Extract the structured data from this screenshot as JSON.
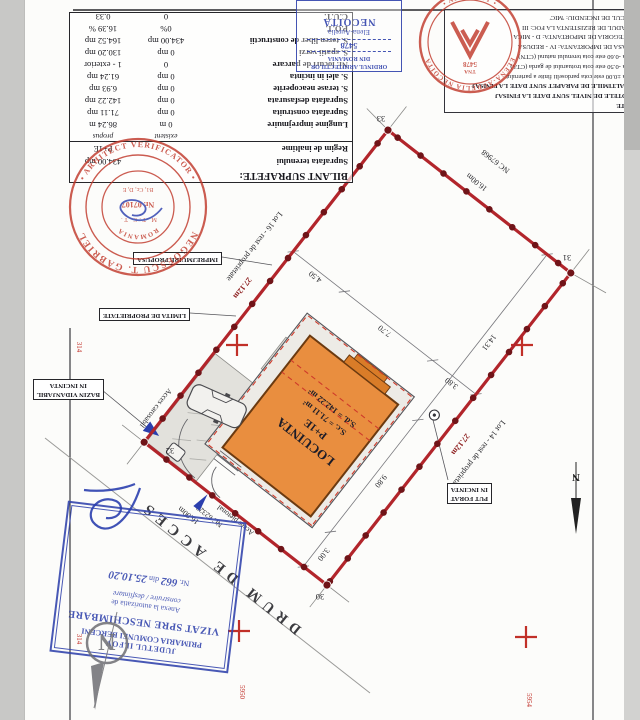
{
  "colors": {
    "boundary_red": "#b2252b",
    "building_orange": "#e98e3f",
    "stamp_red": "#c0392b",
    "stamp_blue": "#3546ad"
  },
  "surface_table": {
    "title": "BILANT SUPRAFETE:",
    "land_label": "Suprafata terenului",
    "land_value": "434.00 mp",
    "regime_label": "Regim de inaltime",
    "regime_value": "P+1E",
    "col_existent": "existent",
    "col_propus": "propus",
    "rows": [
      {
        "label": "Lungime imprejmuire",
        "existent": "0 m",
        "propus": "86.24 m"
      },
      {
        "label": "Suprafata construita",
        "existent": "0 mp",
        "propus": "71.11 mp"
      },
      {
        "label": "Suprafata desfasurata",
        "existent": "0 mp",
        "propus": "142.22 mp"
      },
      {
        "label": "S. terase neacoperite",
        "existent": "0 mp",
        "propus": "6.93 mp"
      },
      {
        "label": "S. alei in incinta",
        "existent": "0 mp",
        "propus": "61.24 mp"
      },
      {
        "label": "Nr. locuri de parcare",
        "existent": "0",
        "propus": "1 - exterior"
      },
      {
        "label": "S. spatii verzi",
        "existent": "0 mp",
        "propus": "130.20 mp"
      },
      {
        "label": "S. teren liber de constructii",
        "existent": "434.00 mp",
        "propus": "164.52 mp"
      },
      {
        "label": "P.O.T.",
        "existent": "0%",
        "propus": "16.39 %"
      },
      {
        "label": "C.U.T.",
        "existent": "0",
        "propus": "0.33"
      }
    ]
  },
  "notes": {
    "title": "NOTE",
    "lines": [
      "*COTELE DE NIVEL SUNT DATE LA FINISAJ",
      "*INALTIMILE DE PARAPET SUNT DATE LA FINISAJ",
      "Cota ±0.00 este cota pardoselii finite a parterului",
      "Cota -0.50 este cota trotuarului de garda (CTA)",
      "Cota -0.60 este cota terenului natural (CTN)",
      "CLASA DE IMPORTANTA: IV - REDUSA",
      "CATEGORIA DE IMPORTANTA: D - MICA",
      "GRADUL DE REZISTENTA LA FOC: III",
      "RISCUL DE INCENDIU: 'MIC'"
    ]
  },
  "plan": {
    "building": {
      "l1": "LOCUINTA",
      "l2": "P+1E",
      "l3": "S.c. = 71.11 m²",
      "l4": "S.d. = 142.22 m²"
    },
    "dims": {
      "front": "16.00m",
      "back": "16.00m",
      "left": "27.12m",
      "right": "27.12m",
      "w1": "3.80",
      "w2": "7.70",
      "w3": "4.50",
      "h1": "3.00",
      "h2": "9.80",
      "h3": "14.31"
    },
    "corners": {
      "c30": "30",
      "c31": "31",
      "c32": "32",
      "c33": "33"
    },
    "labels": {
      "lot14": "Lot 14 - rest de proprietate",
      "lot16": "Lot 16 - rest de proprietate",
      "nc_back": "NC 67968",
      "nc_road": "NC 62323",
      "road": "DRUM DE ACCES",
      "acces_pietonal": "Acces pietonal",
      "acces_carosabil": "Acces carosabil",
      "put_forat_1": "PUT FORAT",
      "put_forat_2": "IN INCINTA",
      "bazin_1": "BAZIN VIDANJABIL",
      "bazin_2": "IN INCINTA",
      "imprejmuire": "IMPREJMUIRE PROPUSA",
      "limita": "LIMITA DE PROPRIETATE",
      "north": "N"
    },
    "grid": {
      "g1": "314",
      "g2": "314",
      "g3": "5950",
      "g4": "5954"
    }
  },
  "stamps": {
    "vizat": {
      "l1": "JUDETUL ILFOV",
      "l2": "PRIMARIA COMUNEI BERCENI",
      "l3": "VIZAT SPRE NESCHIMBARE",
      "l4": "Anexa la autorizatia de",
      "l5": "construire / desfiintare",
      "l6_prefix": "Nr.",
      "l6_no": "662",
      "l6_mid": "din",
      "l6_date": "25.10.20"
    },
    "negoescu": {
      "arc_top": "NEGOESCU T. GABRIEL",
      "arc_bottom": "• ARHITECT VERIFICATOR •",
      "inner_top": "ROMANIA",
      "inner_mtct": "M.T.C.T.",
      "inner_no": "Nr. 07107",
      "inner_cat": "B1, Cc, D, E"
    },
    "tna": {
      "arc_top": "ELENA-AURELIA NECOITA",
      "arc_bottom": "• ARHITECT •",
      "top": "TNA",
      "no": "5478"
    },
    "oar": {
      "l1": "ORDINUL ARHITECTILOR",
      "l2": "DIN ROMANIA",
      "l3": "5478",
      "l4": "Elena-Aurelia",
      "l5": "NECOITA"
    }
  }
}
